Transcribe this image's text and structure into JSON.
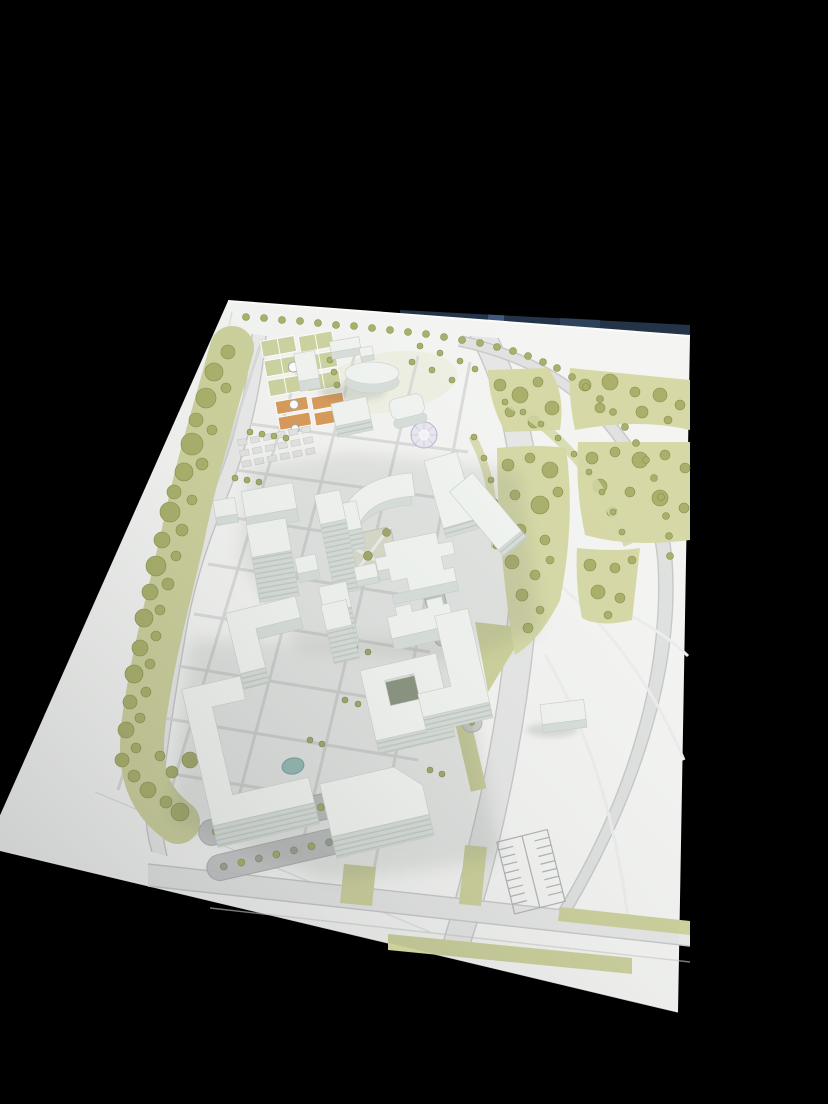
{
  "scene": {
    "alt": "Photograph of a white architectural scale model standing on a printed campus site plan, tilted at an angle against a black background",
    "regions": [
      "black-background",
      "site-plan-board",
      "navy-backdrop-strip",
      "left-tree-belt",
      "top-tree-row",
      "curved-boulevard",
      "right-park",
      "sports-courts",
      "round-pavilion",
      "central-building-cluster",
      "courtyard-buildings",
      "pond",
      "parking-lots",
      "bottom-road"
    ]
  },
  "colors": {
    "background": "#000000",
    "paper": "#f4f5f3",
    "navy_strip": "#233449",
    "navy_glint": "#46628a",
    "road_fill": "#e6e7e6",
    "road_line": "#c7c9c9",
    "park_fill": "#d6d9a6",
    "belt_fill": "#cdd19c",
    "tree_fill": "#aab06a",
    "tree_edge": "#878d4a",
    "court_green": "#ccd39f",
    "court_orange": "#d89a58",
    "parking_gray": "#c2c4c4",
    "building_top": "#f1f4f0",
    "building_side": "#d8deda",
    "courtyard_dark": "#8a9480",
    "pond": "#9cc4c0",
    "shadow": "#6f756f",
    "mandala": "#e9e7f0",
    "lawn": "#e9ecd8"
  }
}
